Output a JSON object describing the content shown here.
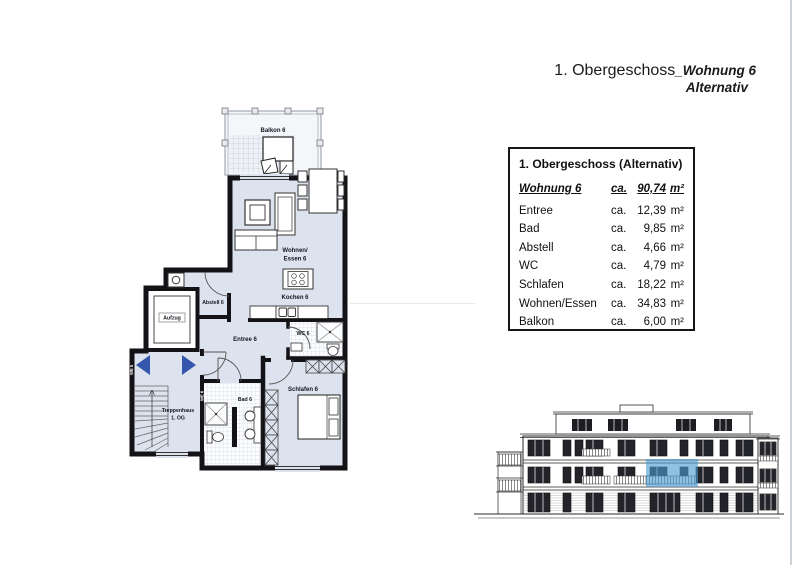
{
  "header": {
    "title_main": "1. Obergeschoss",
    "title_unit": "_Wohnung 6",
    "title_sub": "Alternativ"
  },
  "area_table": {
    "title": "1. Obergeschoss (Alternativ)",
    "area_prefix": "ca.",
    "area_unit": "m²",
    "total": {
      "label": "Wohnung 6",
      "value": "90,74"
    },
    "rows": [
      {
        "room": "Entree",
        "value": "12,39"
      },
      {
        "room": "Bad",
        "value": "9,85"
      },
      {
        "room": "Abstell",
        "value": "4,66"
      },
      {
        "room": "WC",
        "value": "4,79"
      },
      {
        "room": "Schlafen",
        "value": "18,22"
      },
      {
        "room": "Wohnen/Essen",
        "value": "34,83"
      },
      {
        "room": "Balkon",
        "value": "6,00"
      }
    ]
  },
  "floor_plan": {
    "labels": {
      "balkon": "Balkon 6",
      "wohnen_1": "Wohnen/",
      "wohnen_2": "Essen 6",
      "kochen": "Kochen 6",
      "abstell": "Abstell 6",
      "aufzug": "Aufzug",
      "entree": "Entree 6",
      "wc": "WC 6",
      "bad": "Bad 6",
      "schlafen": "Schlafen 6",
      "treppenhaus_1": "Treppenhaus",
      "treppenhaus_2": "1. OG",
      "we5": "WE 5",
      "we6": "WE 6"
    },
    "colors": {
      "floor": "#dce3ee",
      "wall": "#121217",
      "unit_arrow": "#3457ad"
    }
  },
  "elevation": {
    "highlight_color": "#4a9bd0"
  }
}
